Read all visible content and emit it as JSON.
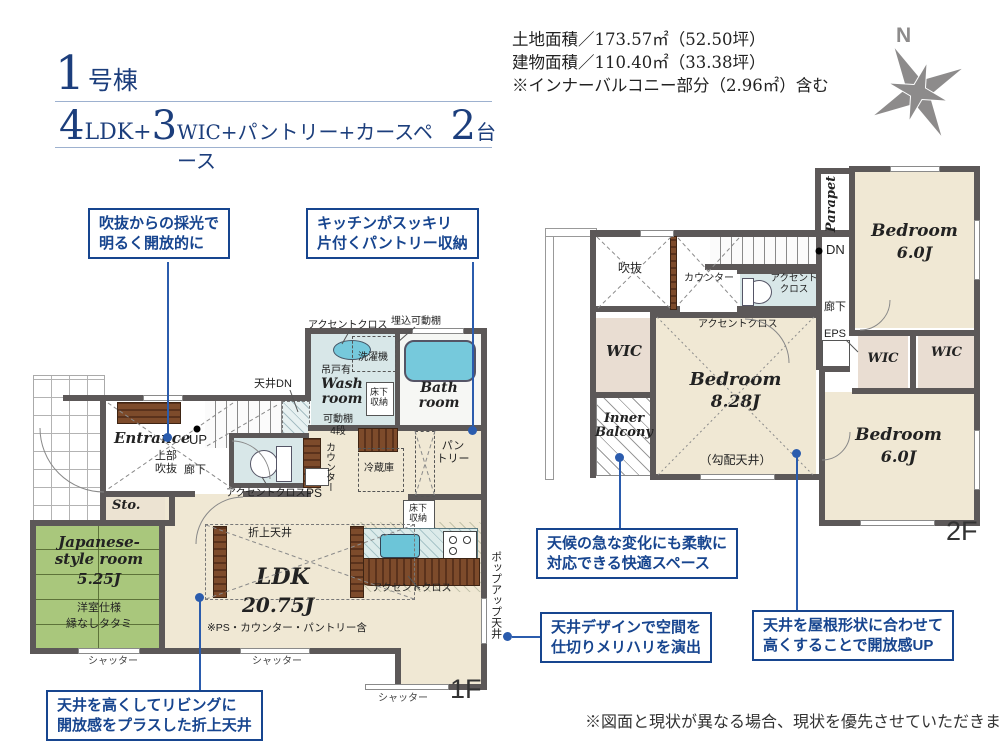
{
  "colors": {
    "accent_blue": "#17458f",
    "wall": "#5c5858",
    "tatami": "#a9c77c",
    "floor_beige": "#f0e8d4",
    "water_blue": "#76c9dc",
    "callout_line": "#2b5cad"
  },
  "header": {
    "title_num": "1",
    "title_suffix": "号棟",
    "spec_n1": "4",
    "spec_t1": "LDK+",
    "spec_n2": "3",
    "spec_t2": "WIC+パントリー+カースペース",
    "spec_n3": "2",
    "spec_t3": "台",
    "site_line1": "土地面積／173.57㎡（52.50坪）",
    "site_line2": "建物面積／110.40㎡（33.38坪）",
    "site_line3": "※インナーバルコニー部分（2.96㎡）含む",
    "compass_n": "N"
  },
  "callouts": {
    "c1a": "吹抜からの採光で",
    "c1b": "明るく開放的に",
    "c2a": "キッチンがスッキリ",
    "c2b": "片付くパントリー収納",
    "c3a": "天候の急な変化にも柔軟に",
    "c3b": "対応できる快適スペース",
    "c4a": "天井デザインで空間を",
    "c4b": "仕切りメリハリを演出",
    "c5a": "天井を屋根形状に合わせて",
    "c5b": "高くすることで開放感UP",
    "c6a": "天井を高くしてリビングに",
    "c6b": "開放感をプラスした折上天井"
  },
  "labels": {
    "accent": "アクセントクロス",
    "accent_a": "アクセント",
    "accent_b": "クロス",
    "recessed_shelf": "埋込可動棚",
    "washer": "洗濯機",
    "hanging_cab": "吊戸有",
    "wash_a": "Wash",
    "wash_b": "room",
    "ufs_a": "床下",
    "ufs_b": "収納",
    "shelf_a": "可動棚",
    "shelf_b": "4段",
    "bath_a": "Bath",
    "bath_b": "room",
    "ceiling_dn": "天井DN",
    "up": "UP",
    "dn": "DN",
    "entrance": "Entrance",
    "upper_a": "上部",
    "upper_b": "吹抜",
    "hallway": "廊下",
    "sto": "Sto.",
    "ps": "PS",
    "counter": "カウンター",
    "pantry_a": "パン",
    "pantry_b": "トリー",
    "fridge": "冷蔵庫",
    "jp_a": "Japanese-",
    "jp_b": "style room",
    "jp_size": "5.25J",
    "jp_note1": "洋室仕様",
    "jp_note2": "縁なしタタミ",
    "shutter": "シャッター",
    "coffered": "折上天井",
    "ldk": "LDK",
    "ldk_size": "20.75J",
    "ldk_note": "※PS・カウンター・パントリー含",
    "popup": "ポップアップ天井",
    "f1": "1F",
    "f2": "2F",
    "void": "吹抜",
    "parapet": "Parapet",
    "eps": "EPS",
    "wic": "WIC",
    "inner_a": "Inner",
    "inner_b": "Balcony",
    "bedroom": "Bedroom",
    "bed_main_size": "8.28J",
    "bed_size": "6.0J",
    "sloped": "（勾配天井）"
  },
  "footer": {
    "disclaimer": "※図面と現状が異なる場合、現状を優先させていただきます。"
  }
}
